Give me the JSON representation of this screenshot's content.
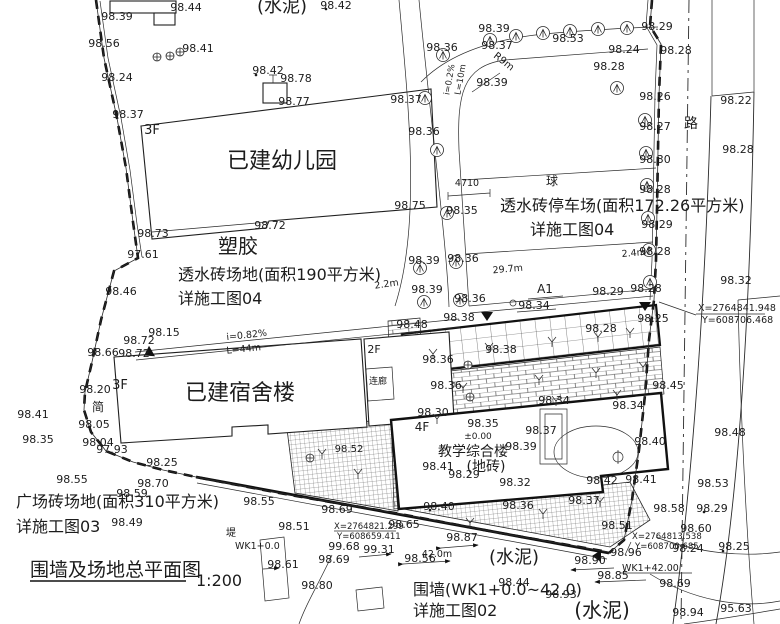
{
  "title": {
    "text": "围墙及场地总平面图",
    "scale": "1:200"
  },
  "colors": {
    "line": "#1f1f1f",
    "background": "#ffffff"
  },
  "drawing": {
    "labels": [
      {
        "t": "98.39",
        "x": 117,
        "y": 20
      },
      {
        "t": "98.44",
        "x": 186,
        "y": 11
      },
      {
        "t": "(水泥)",
        "x": 282,
        "y": 12,
        "s": 18,
        "n": "area-label-cement"
      },
      {
        "t": "98.42",
        "x": 336,
        "y": 9
      },
      {
        "t": "98.56",
        "x": 104,
        "y": 47
      },
      {
        "t": "98.41",
        "x": 198,
        "y": 52
      },
      {
        "t": "98.24",
        "x": 117,
        "y": 81
      },
      {
        "t": "98.42",
        "x": 268,
        "y": 74
      },
      {
        "t": "98.78",
        "x": 296,
        "y": 82
      },
      {
        "t": "98.77",
        "x": 294,
        "y": 105
      },
      {
        "t": "98.37",
        "x": 128,
        "y": 118
      },
      {
        "t": "3F",
        "x": 152,
        "y": 134,
        "s": 13,
        "n": "storey-label"
      },
      {
        "t": "已建幼儿园",
        "x": 282,
        "y": 168,
        "s": 22,
        "n": "building-label-kindergarten"
      },
      {
        "t": "98.72",
        "x": 270,
        "y": 229
      },
      {
        "t": "98.73",
        "x": 153,
        "y": 237
      },
      {
        "t": "塑胶",
        "x": 238,
        "y": 253,
        "s": 20,
        "n": "area-label-rubber"
      },
      {
        "t": "97.61",
        "x": 143,
        "y": 258
      },
      {
        "t": "透水砖场地(面积190平方米)",
        "x": 178,
        "y": 280,
        "s": 16,
        "a": "start",
        "n": "note-permeable-brick-ground"
      },
      {
        "t": "详施工图04",
        "x": 178,
        "y": 304,
        "s": 16,
        "a": "start",
        "n": "note-detail-04"
      },
      {
        "t": "98.46",
        "x": 121,
        "y": 295
      },
      {
        "t": "98.39",
        "x": 494,
        "y": 32
      },
      {
        "t": "98.53",
        "x": 568,
        "y": 42
      },
      {
        "t": "98.37",
        "x": 497,
        "y": 49
      },
      {
        "t": "98.36",
        "x": 442,
        "y": 51
      },
      {
        "t": "R9m",
        "x": 502,
        "y": 64,
        "s": 10,
        "r": 38
      },
      {
        "t": "98.39",
        "x": 492,
        "y": 86
      },
      {
        "t": "98.29",
        "x": 657,
        "y": 30
      },
      {
        "t": "98.24",
        "x": 624,
        "y": 53
      },
      {
        "t": "98.28",
        "x": 676,
        "y": 54
      },
      {
        "t": "98.28",
        "x": 609,
        "y": 70
      },
      {
        "t": "98.26",
        "x": 655,
        "y": 100
      },
      {
        "t": "98.27",
        "x": 655,
        "y": 130
      },
      {
        "t": "98.30",
        "x": 655,
        "y": 163
      },
      {
        "t": "98.28",
        "x": 655,
        "y": 193
      },
      {
        "t": "98.29",
        "x": 657,
        "y": 228
      },
      {
        "t": "98.28",
        "x": 655,
        "y": 255
      },
      {
        "t": "路",
        "x": 691,
        "y": 128,
        "s": 14,
        "n": "road-label"
      },
      {
        "t": "98.22",
        "x": 736,
        "y": 104
      },
      {
        "t": "98.28",
        "x": 738,
        "y": 153
      },
      {
        "t": "98.32",
        "x": 736,
        "y": 284
      },
      {
        "t": "X=2764841.948",
        "x": 698,
        "y": 311,
        "s": 9.5,
        "a": "start",
        "n": "coordinate-label"
      },
      {
        "t": "Y=608706.468",
        "x": 702,
        "y": 323,
        "s": 9.5,
        "a": "start",
        "n": "coordinate-label"
      },
      {
        "t": "98.37",
        "x": 406,
        "y": 103
      },
      {
        "t": "98.36",
        "x": 424,
        "y": 135
      },
      {
        "t": "98.75",
        "x": 410,
        "y": 209
      },
      {
        "t": "98.35",
        "x": 462,
        "y": 214
      },
      {
        "t": "4710",
        "x": 467,
        "y": 186,
        "s": 9.5
      },
      {
        "t": "球",
        "x": 552,
        "y": 185,
        "s": 12
      },
      {
        "t": "透水砖停车场(面积172.26平方米)",
        "x": 500,
        "y": 211,
        "s": 16,
        "a": "start",
        "n": "note-permeable-brick-parking"
      },
      {
        "t": "详施工图04",
        "x": 530,
        "y": 235,
        "s": 16,
        "a": "start",
        "n": "note-detail-04"
      },
      {
        "t": "i=0.2%",
        "x": 452,
        "y": 80,
        "s": 8.5,
        "r": -80
      },
      {
        "t": "L=10m",
        "x": 463,
        "y": 80,
        "s": 8.5,
        "r": -80
      },
      {
        "t": "2.2m",
        "x": 387,
        "y": 287,
        "s": 9.5,
        "r": -8
      },
      {
        "t": "29.7m",
        "x": 508,
        "y": 272,
        "s": 9.5,
        "r": -5
      },
      {
        "t": "2.4m",
        "x": 634,
        "y": 256,
        "s": 9.5,
        "r": -5
      },
      {
        "t": "98.39",
        "x": 424,
        "y": 264
      },
      {
        "t": "98.36",
        "x": 463,
        "y": 262
      },
      {
        "t": "98.39",
        "x": 427,
        "y": 293
      },
      {
        "t": "98.36",
        "x": 470,
        "y": 302
      },
      {
        "t": "A1",
        "x": 545,
        "y": 293,
        "s": 12,
        "n": "section-marker-label"
      },
      {
        "t": "98.34",
        "x": 534,
        "y": 309
      },
      {
        "t": "98.29",
        "x": 608,
        "y": 295
      },
      {
        "t": "98.28",
        "x": 646,
        "y": 292
      },
      {
        "t": "98.38",
        "x": 459,
        "y": 321
      },
      {
        "t": "98.48",
        "x": 412,
        "y": 328
      },
      {
        "t": "98.28",
        "x": 601,
        "y": 332
      },
      {
        "t": "98.25",
        "x": 653,
        "y": 322
      },
      {
        "t": "98.38",
        "x": 501,
        "y": 353
      },
      {
        "t": "98.36",
        "x": 438,
        "y": 363
      },
      {
        "t": "98.36",
        "x": 446,
        "y": 389
      },
      {
        "t": "98.34",
        "x": 554,
        "y": 404
      },
      {
        "t": "98.45",
        "x": 668,
        "y": 389
      },
      {
        "t": "98.34",
        "x": 628,
        "y": 409
      },
      {
        "t": "98.30",
        "x": 433,
        "y": 416
      },
      {
        "t": "98.48",
        "x": 730,
        "y": 436
      },
      {
        "t": "98.40",
        "x": 650,
        "y": 445
      },
      {
        "t": "98.15",
        "x": 164,
        "y": 336
      },
      {
        "t": "98.72",
        "x": 139,
        "y": 344
      },
      {
        "t": "i=0.82%",
        "x": 247,
        "y": 338,
        "s": 9.5,
        "r": -6
      },
      {
        "t": "L=44m",
        "x": 244,
        "y": 352,
        "s": 9.5,
        "r": -6
      },
      {
        "t": "98.66",
        "x": 103,
        "y": 356
      },
      {
        "t": "98.72",
        "x": 134,
        "y": 357
      },
      {
        "t": "2F",
        "x": 374,
        "y": 353,
        "s": 11,
        "n": "storey-label"
      },
      {
        "t": "3F",
        "x": 120,
        "y": 389,
        "s": 13,
        "n": "storey-label"
      },
      {
        "t": "98.20",
        "x": 95,
        "y": 393
      },
      {
        "t": "已建宿舍楼",
        "x": 240,
        "y": 400,
        "s": 22,
        "n": "building-label-dormitory"
      },
      {
        "t": "简",
        "x": 98,
        "y": 411,
        "s": 12
      },
      {
        "t": "98.41",
        "x": 33,
        "y": 418
      },
      {
        "t": "98.05",
        "x": 94,
        "y": 428
      },
      {
        "t": "98.35",
        "x": 38,
        "y": 443
      },
      {
        "t": "98.04",
        "x": 98,
        "y": 446
      },
      {
        "t": "97.93",
        "x": 112,
        "y": 453
      },
      {
        "t": "98.25",
        "x": 162,
        "y": 466
      },
      {
        "t": "连廊",
        "x": 378,
        "y": 384,
        "s": 9,
        "n": "corridor-label"
      },
      {
        "t": "98.52",
        "x": 349,
        "y": 452,
        "s": 10
      },
      {
        "t": "4F",
        "x": 422,
        "y": 431,
        "s": 12,
        "n": "storey-label"
      },
      {
        "t": "98.35",
        "x": 483,
        "y": 427
      },
      {
        "t": "±0.00",
        "x": 478,
        "y": 439,
        "s": 9
      },
      {
        "t": "98.37",
        "x": 541,
        "y": 434
      },
      {
        "t": "98.39",
        "x": 521,
        "y": 450
      },
      {
        "t": "教学综合楼",
        "x": 473,
        "y": 456,
        "s": 14,
        "n": "building-label-teaching"
      },
      {
        "t": "(地砖)",
        "x": 486,
        "y": 471,
        "s": 14,
        "n": "area-label-floor-tile"
      },
      {
        "t": "98.41",
        "x": 438,
        "y": 470
      },
      {
        "t": "98.29",
        "x": 464,
        "y": 478
      },
      {
        "t": "98.32",
        "x": 515,
        "y": 486
      },
      {
        "t": "98.42",
        "x": 602,
        "y": 484
      },
      {
        "t": "98.41",
        "x": 641,
        "y": 483
      },
      {
        "t": "98.37",
        "x": 584,
        "y": 504
      },
      {
        "t": "98.36",
        "x": 518,
        "y": 509
      },
      {
        "t": "98.40",
        "x": 439,
        "y": 510
      },
      {
        "t": "98.55",
        "x": 72,
        "y": 483
      },
      {
        "t": "98.70",
        "x": 153,
        "y": 487
      },
      {
        "t": "98.59",
        "x": 132,
        "y": 497
      },
      {
        "t": "广场砖场地(面积310平方米)",
        "x": 16,
        "y": 507,
        "s": 16,
        "a": "start",
        "n": "note-plaza-brick-ground"
      },
      {
        "t": "98.55",
        "x": 259,
        "y": 505
      },
      {
        "t": "详施工图03",
        "x": 16,
        "y": 532,
        "s": 16,
        "a": "start",
        "n": "note-detail-03"
      },
      {
        "t": "98.49",
        "x": 127,
        "y": 526
      },
      {
        "t": "98.51",
        "x": 294,
        "y": 530
      },
      {
        "t": "堤",
        "x": 231,
        "y": 536,
        "s": 10
      },
      {
        "t": "WK1+0.0",
        "x": 235,
        "y": 549,
        "s": 9.5,
        "a": "start",
        "n": "wall-station-label"
      },
      {
        "t": "98.61",
        "x": 283,
        "y": 568
      },
      {
        "t": "围墙及场地总平面图",
        "x": 30,
        "y": 576,
        "s": 19,
        "a": "start",
        "n": "drawing-title"
      },
      {
        "t": "1:200",
        "x": 196,
        "y": 586,
        "s": 16,
        "a": "start",
        "n": "drawing-scale"
      },
      {
        "t": "98.69",
        "x": 337,
        "y": 513
      },
      {
        "t": "X=2764821.299",
        "x": 334,
        "y": 529,
        "s": 8.5,
        "a": "start",
        "n": "coordinate-label"
      },
      {
        "t": "Y=608659.411",
        "x": 337,
        "y": 539,
        "s": 8.5,
        "a": "start",
        "n": "coordinate-label"
      },
      {
        "t": "99.68",
        "x": 344,
        "y": 550
      },
      {
        "t": "99.31",
        "x": 379,
        "y": 553
      },
      {
        "t": "98.69",
        "x": 334,
        "y": 563
      },
      {
        "t": "98.80",
        "x": 317,
        "y": 589
      },
      {
        "t": "98.65",
        "x": 404,
        "y": 528
      },
      {
        "t": "98.87",
        "x": 462,
        "y": 541
      },
      {
        "t": "98.56",
        "x": 420,
        "y": 562
      },
      {
        "t": "42.0m",
        "x": 437,
        "y": 557,
        "s": 9.5
      },
      {
        "t": "(水泥)",
        "x": 514,
        "y": 563,
        "s": 18,
        "n": "area-label-cement"
      },
      {
        "t": "围墙(WK1+0.0~42.0)",
        "x": 413,
        "y": 595,
        "s": 16,
        "a": "start",
        "n": "note-wall"
      },
      {
        "t": "98.44",
        "x": 514,
        "y": 586
      },
      {
        "t": "98.93",
        "x": 561,
        "y": 598
      },
      {
        "t": "详施工图02",
        "x": 413,
        "y": 616,
        "s": 16,
        "a": "start",
        "n": "note-detail-02"
      },
      {
        "t": "(水泥)",
        "x": 602,
        "y": 617,
        "s": 20,
        "n": "area-label-cement"
      },
      {
        "t": "98.90",
        "x": 590,
        "y": 564
      },
      {
        "t": "98.96",
        "x": 626,
        "y": 556
      },
      {
        "t": "WK1+42.00",
        "x": 622,
        "y": 571,
        "s": 9.5,
        "a": "start",
        "n": "wall-station-label"
      },
      {
        "t": "98.85",
        "x": 613,
        "y": 579
      },
      {
        "t": "98.51",
        "x": 617,
        "y": 529
      },
      {
        "t": "X=2764813.538",
        "x": 632,
        "y": 539,
        "s": 8.5,
        "a": "start",
        "n": "coordinate-label"
      },
      {
        "t": "Y=608700.685",
        "x": 635,
        "y": 549,
        "s": 8.5,
        "a": "start",
        "n": "coordinate-label"
      },
      {
        "t": "98.53",
        "x": 713,
        "y": 487
      },
      {
        "t": "98.58",
        "x": 669,
        "y": 512
      },
      {
        "t": "98.29",
        "x": 712,
        "y": 512
      },
      {
        "t": "98.60",
        "x": 696,
        "y": 532
      },
      {
        "t": "98.24",
        "x": 688,
        "y": 552
      },
      {
        "t": "98.25",
        "x": 734,
        "y": 550
      },
      {
        "t": "98.69",
        "x": 675,
        "y": 587
      },
      {
        "t": "98.94",
        "x": 688,
        "y": 616
      },
      {
        "t": "95.63",
        "x": 736,
        "y": 612
      }
    ],
    "trees": [
      [
        490,
        40
      ],
      [
        516,
        36
      ],
      [
        543,
        33
      ],
      [
        570,
        31
      ],
      [
        598,
        29
      ],
      [
        627,
        28
      ],
      [
        443,
        55
      ],
      [
        425,
        98
      ],
      [
        437,
        150
      ],
      [
        447,
        213
      ],
      [
        617,
        88
      ],
      [
        645,
        120
      ],
      [
        646,
        153
      ],
      [
        647,
        185
      ],
      [
        648,
        218
      ],
      [
        649,
        250
      ],
      [
        650,
        282
      ],
      [
        420,
        268
      ],
      [
        456,
        262
      ],
      [
        424,
        302
      ],
      [
        460,
        300
      ]
    ],
    "plus_trees": [
      [
        157,
        57
      ],
      [
        170,
        56
      ],
      [
        180,
        52
      ],
      [
        468,
        365
      ],
      [
        470,
        397
      ],
      [
        310,
        458
      ]
    ],
    "plants": [
      [
        433,
        352
      ],
      [
        489,
        346
      ],
      [
        552,
        340
      ],
      [
        598,
        335
      ],
      [
        630,
        331
      ],
      [
        463,
        386
      ],
      [
        539,
        378
      ],
      [
        596,
        371
      ],
      [
        643,
        365
      ],
      [
        437,
        417
      ],
      [
        556,
        399
      ],
      [
        617,
        393
      ],
      [
        470,
        521
      ],
      [
        543,
        512
      ],
      [
        600,
        500
      ],
      [
        322,
        452
      ],
      [
        358,
        472
      ]
    ],
    "dots": [
      [
        326,
        9
      ],
      [
        256,
        75
      ],
      [
        704,
        512
      ],
      [
        430,
        510
      ],
      [
        723,
        551
      ]
    ],
    "triangles": [
      [
        487,
        312,
        0
      ],
      [
        645,
        302,
        0
      ],
      [
        152,
        351,
        60
      ],
      [
        601,
        556,
        90
      ]
    ]
  }
}
